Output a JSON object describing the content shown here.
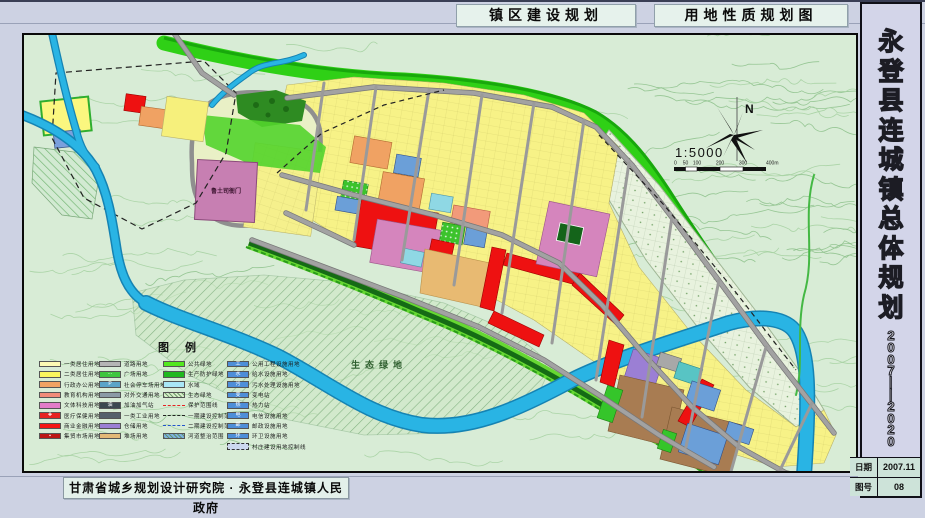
{
  "titles": {
    "left": "镇区建设规划",
    "right": "用地性质规划图"
  },
  "sidebar": {
    "title": "永登县连城镇总体规划",
    "title_chars": [
      "永",
      "登",
      "县",
      "连",
      "城",
      "镇",
      "总",
      "体",
      "规",
      "划"
    ],
    "period": "2007—2020",
    "period_chars": [
      "2",
      "0",
      "0",
      "7",
      "—",
      "—",
      "2",
      "0",
      "2",
      "0"
    ],
    "date_label": "日期",
    "date_value": "2007.11",
    "sheet_label": "图号",
    "sheet_value": "08"
  },
  "footer": {
    "attribution": "甘肃省城乡规划设计研究院 · 永登县连城镇人民政府"
  },
  "map": {
    "north_label": "N",
    "scale_text": "1:5000",
    "scale_ticks": [
      "0",
      "50",
      "100",
      "200",
      "300",
      "400m"
    ],
    "labels": {
      "palace": "鲁土司衙门",
      "eco_green": "生态绿地"
    },
    "colors": {
      "water": "#29b4e4",
      "road": "#a2a2a2",
      "residential1": "#fdfab4",
      "residential2": "#f8f388",
      "commercial": "#ee1111",
      "culture": "#d585bd",
      "admin": "#f0a263",
      "warehouse": "#9b7fd4",
      "industry": "#a87c52",
      "utility": "#6b9fd8",
      "green_belt": "#2fd016",
      "eco": "#cfe8c6"
    }
  },
  "legend": {
    "title": "图例",
    "columns": [
      [
        {
          "label": "一类居住用地",
          "color": "#fdfab4",
          "kind": "solid"
        },
        {
          "label": "二类居住用地",
          "color": "#fbf75e",
          "kind": "solid"
        },
        {
          "label": "行政办公用地",
          "color": "#f0a263",
          "kind": "solid"
        },
        {
          "label": "教育机构用地",
          "color": "#f08a78",
          "kind": "solid"
        },
        {
          "label": "文体科技用地",
          "color": "#e27cc8",
          "kind": "solid"
        },
        {
          "label": "医疗保健用地",
          "color": "#e62222",
          "kind": "solid",
          "icon": "✚"
        },
        {
          "label": "商业金融用地",
          "color": "#f51515",
          "kind": "solid"
        },
        {
          "label": "集贸市场用地",
          "color": "#bc1616",
          "kind": "solid",
          "icon": "▪"
        }
      ],
      [
        {
          "label": "道路用地",
          "color": "#b5b5b5",
          "kind": "solid"
        },
        {
          "label": "广场用地",
          "color": "#3ec63e",
          "kind": "solid",
          "icon": "⋯"
        },
        {
          "label": "社会停车场用地",
          "color": "#5ba4c8",
          "kind": "solid",
          "icon": "P"
        },
        {
          "label": "对外交通用地",
          "color": "#8b9aa6",
          "kind": "solid"
        },
        {
          "label": "加油加气站",
          "color": "#3c4850",
          "kind": "solid",
          "icon": "油"
        },
        {
          "label": "一类工业用地",
          "color": "#55606c",
          "kind": "solid"
        },
        {
          "label": "仓储用地",
          "color": "#9b7fd4",
          "kind": "solid"
        },
        {
          "label": "堆场用地",
          "color": "#e3b877",
          "kind": "solid"
        }
      ],
      [
        {
          "label": "公共绿地",
          "color": "#52e81f",
          "kind": "solid"
        },
        {
          "label": "生产防护绿地",
          "color": "#1fb81f",
          "kind": "solid"
        },
        {
          "label": "水域",
          "color": "#a9e6f6",
          "kind": "solid"
        },
        {
          "label": "生态绿地",
          "color": "#d9eecb",
          "kind": "hatch"
        },
        {
          "label": "保护范围线",
          "color": "#e62222",
          "kind": "line"
        },
        {
          "label": "一期建设控制范围",
          "color": "#222222",
          "kind": "line"
        },
        {
          "label": "二期建设控制范围",
          "color": "#2255cc",
          "kind": "line"
        },
        {
          "label": "河道整治范围",
          "color": "#7fb0e0",
          "kind": "hatch"
        }
      ],
      [
        {
          "label": "公用工程设施用地",
          "color": "#4e8ed8",
          "kind": "solid",
          "icon": "工"
        },
        {
          "label": "给水设施用地",
          "color": "#4e8ed8",
          "kind": "solid",
          "icon": "水"
        },
        {
          "label": "污水处理设施用地",
          "color": "#4e8ed8",
          "kind": "solid",
          "icon": "污"
        },
        {
          "label": "变电站",
          "color": "#4e8ed8",
          "kind": "solid",
          "icon": "变"
        },
        {
          "label": "热力站",
          "color": "#4e8ed8",
          "kind": "solid",
          "icon": "热"
        },
        {
          "label": "电信设施用地",
          "color": "#4e8ed8",
          "kind": "solid",
          "icon": "电"
        },
        {
          "label": "邮政设施用地",
          "color": "#4e8ed8",
          "kind": "solid",
          "icon": "邮"
        },
        {
          "label": "环卫设施用地",
          "color": "#4e8ed8",
          "kind": "solid",
          "icon": "环"
        },
        {
          "label": "村庄建设用地控制线",
          "color": "#b8c8e8",
          "kind": "dashedbox"
        }
      ]
    ]
  }
}
